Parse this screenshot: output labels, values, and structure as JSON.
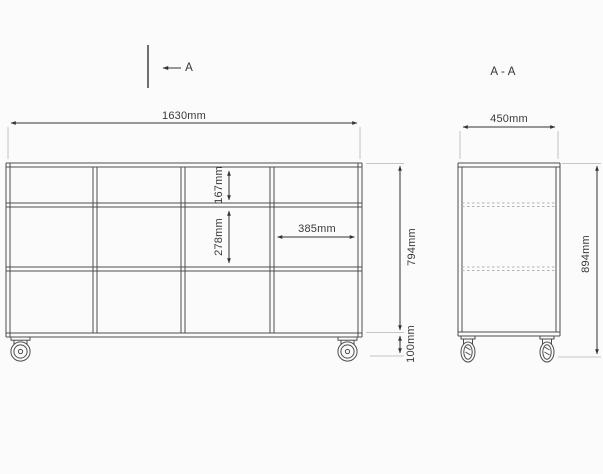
{
  "colors": {
    "background": "#fbfbfb",
    "outline": "#4d4d4d",
    "dimension": "#333333",
    "extension": "#b5b5b5",
    "hidden_dashed": "#b3b3b3",
    "text": "#3a3a3a"
  },
  "section_marker": {
    "label": "A"
  },
  "section_view": {
    "title": "A - A",
    "depth": "450mm",
    "total_height": "894mm"
  },
  "front_view": {
    "width": "1630mm",
    "body_height": "794mm",
    "caster_height": "100mm",
    "top_row_height": "167mm",
    "middle_row_height": "278mm",
    "compartment_width": "385mm",
    "grid": {
      "rows": 3,
      "columns": 4
    }
  }
}
